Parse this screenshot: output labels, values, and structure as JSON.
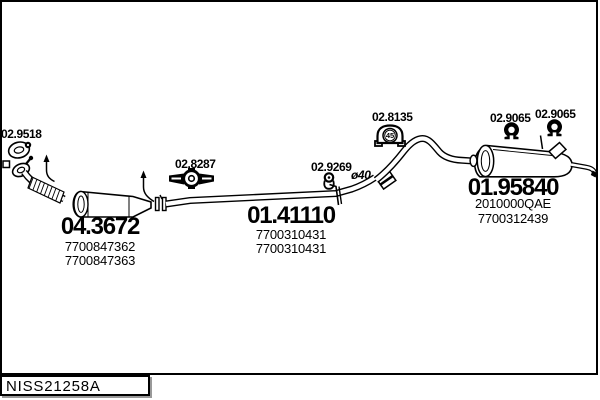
{
  "annotations": {
    "gasket_label": "02.9518",
    "front_mount_label": "02.8287",
    "clamp_label": "02.9269",
    "diameter_note": "ø40",
    "mid_mount_label": "02.8135",
    "mid_mount_number": "45",
    "rear_mount_label_1": "02.9065",
    "rear_mount_label_2": "02.9065"
  },
  "parts": {
    "catalyst": {
      "code": "04.3672",
      "oem_1": "7700847362",
      "oem_2": "7700847363"
    },
    "centre_pipe": {
      "code": "01.41110",
      "oem_1": "7700310431",
      "oem_2": "7700310431"
    },
    "rear_silencer": {
      "code": "01.95840",
      "oem_1": "2010000QAE",
      "oem_2": "7700312439"
    }
  },
  "footer": {
    "catalog_code": "NISS21258A"
  }
}
